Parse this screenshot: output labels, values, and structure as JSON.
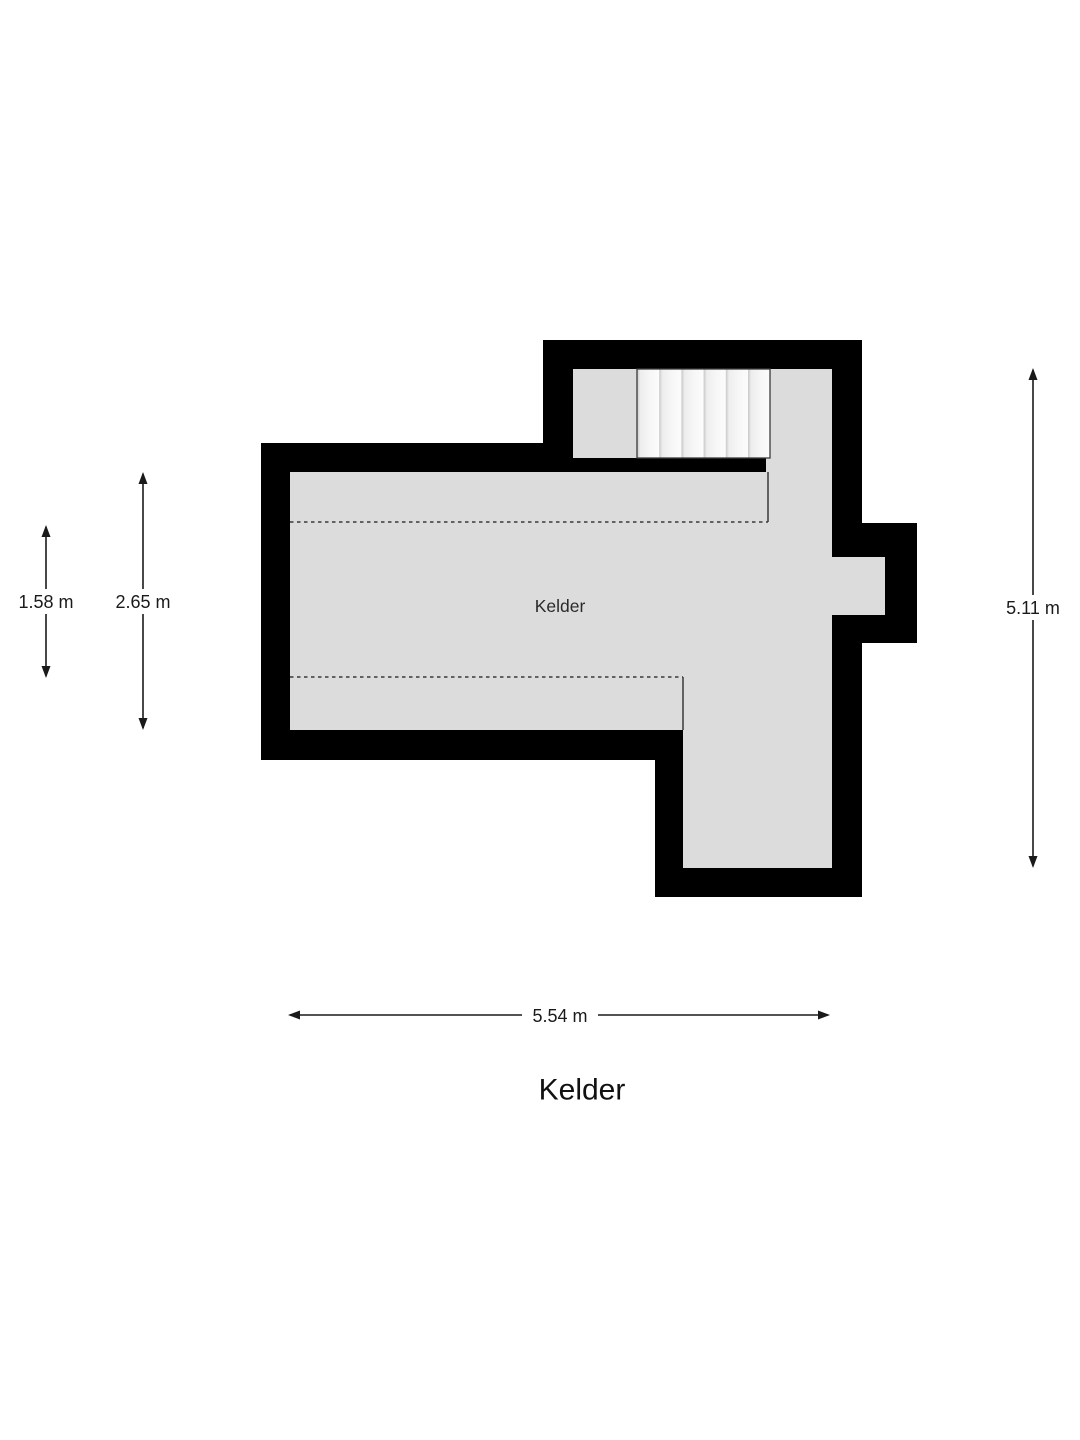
{
  "floor_plan": {
    "room_label": "Kelder",
    "title": "Kelder",
    "colors": {
      "wall": "#000000",
      "floor": "#dcdcdc",
      "stair_tread_light": "#f7f7f7",
      "dimension_line": "#1a1a1a"
    },
    "dimensions": [
      {
        "label": "1.58 m",
        "orientation": "vertical"
      },
      {
        "label": "2.65 m",
        "orientation": "vertical"
      },
      {
        "label": "5.11 m",
        "orientation": "vertical"
      },
      {
        "label": "5.54 m",
        "orientation": "horizontal"
      }
    ]
  }
}
